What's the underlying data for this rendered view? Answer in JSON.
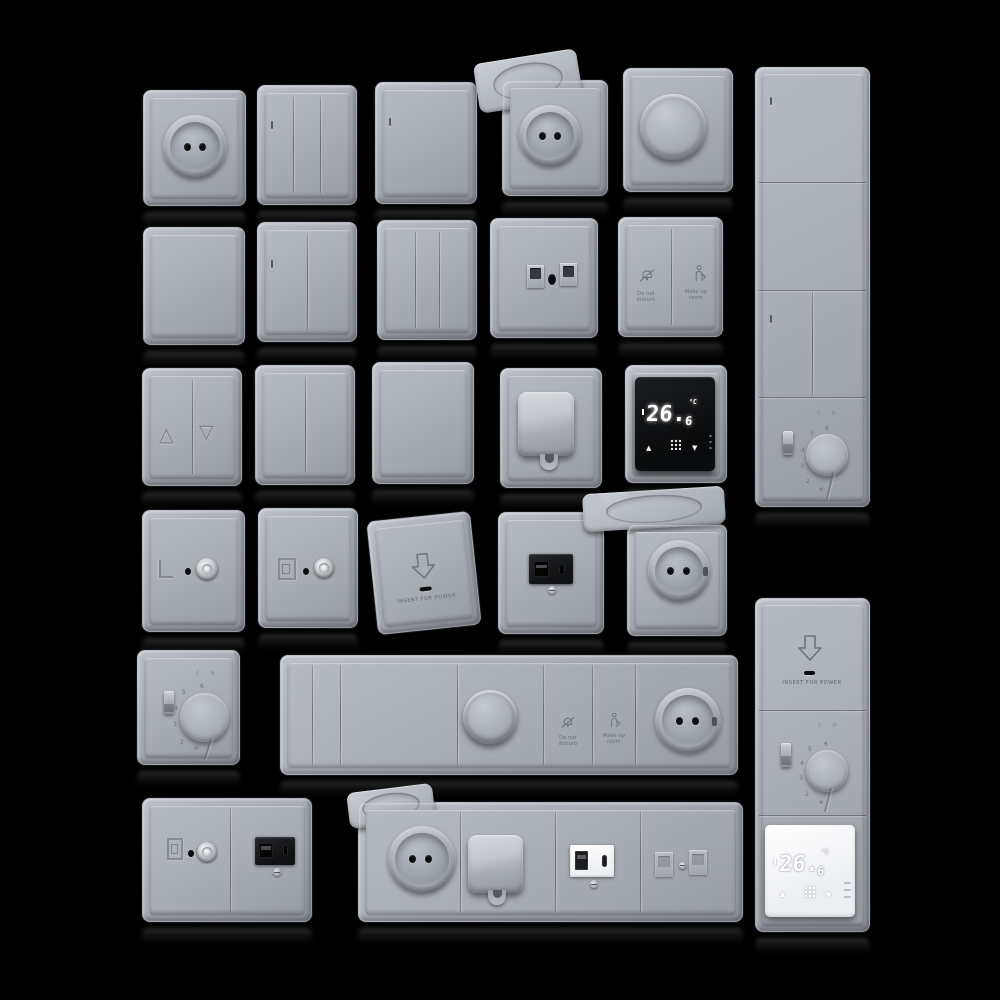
{
  "scene": {
    "description": "3D rendered catalog of gray wall switches, power sockets, dimmers, USB and data outlets, hotel switches and thermostats on a black background",
    "background_color": "#000000",
    "plate_color": "#a7acb3",
    "black_module_color": "#141619",
    "white_module_color": "#f3f4f6",
    "display_digit_color": "#ffffff"
  },
  "labels": {
    "do_not_disturb_line1": "Do not",
    "do_not_disturb_line2": "disturb",
    "make_up_room_line1": "Make up",
    "make_up_room_line2": "room",
    "insert_for_power": "INSERT FOR POWER"
  },
  "thermostat_display": {
    "reading_main": "26.",
    "reading_decimal": "6",
    "unit": "°C",
    "up_arrow": "▲",
    "down_arrow": "▼"
  },
  "dial_thermostat": {
    "n2": "2",
    "n3": "3",
    "n4": "4",
    "n5": "5",
    "n6": "6",
    "frost": "❄",
    "mode_night": "☾",
    "mode_day": "☼"
  },
  "blinds_switch": {
    "up": "△",
    "down": "▽"
  }
}
